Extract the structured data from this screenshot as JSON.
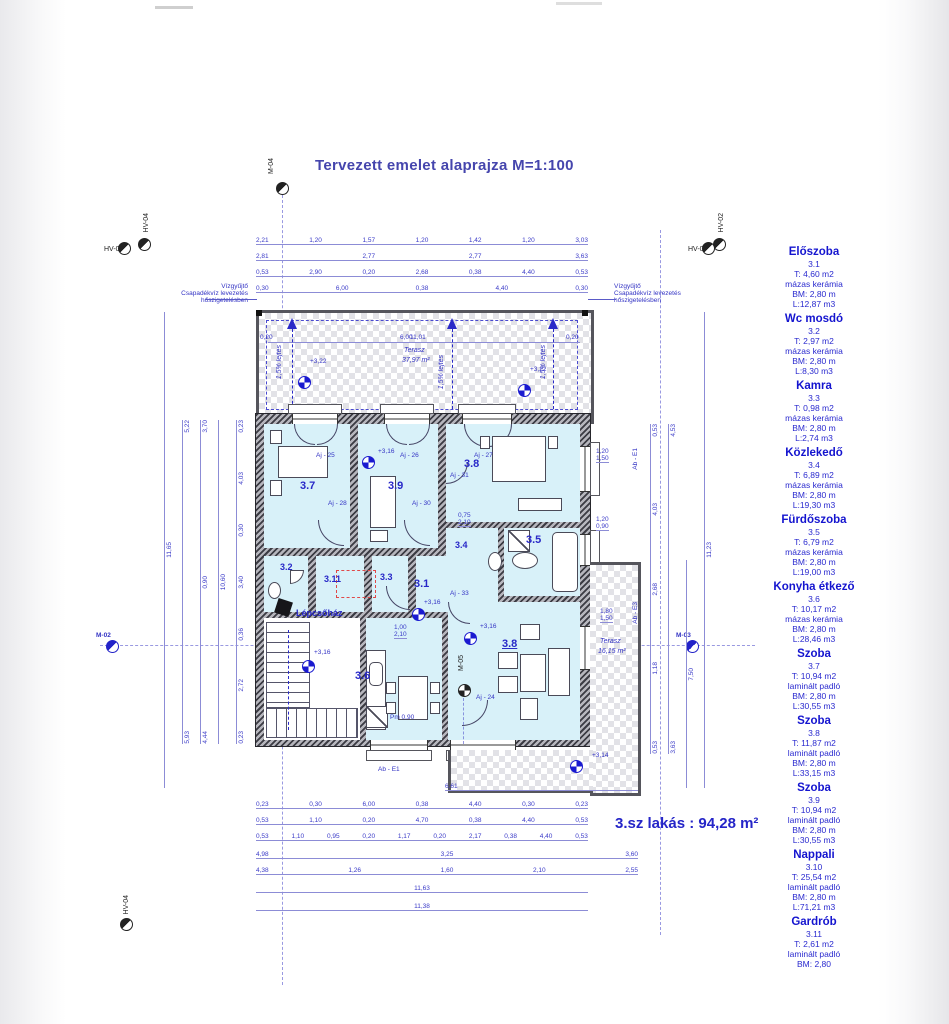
{
  "title": "Tervezett  emelet alaprajza M=1:100",
  "apartment_total": "3.sz lakás : 94,28 m²",
  "notes": {
    "line1": "Vízgyűjtő",
    "line2": "Csapadékvíz levezetés",
    "line3": "hőszigetelésben"
  },
  "markers": {
    "m04": "M-04",
    "m05": "M-05",
    "m02": "M-02",
    "m03": "M-03",
    "hv02": "HV-02",
    "hv03": "HV-03",
    "hv04": "HV-04"
  },
  "terrace_top": {
    "name": "Terasz",
    "area": "37,97 m²",
    "slope": "1,5% lejtés",
    "level": "+3,22",
    "width": "11,01",
    "edge": "0,20"
  },
  "terrace_right": {
    "name": "Terasz",
    "area": "16,15 m²",
    "level": "+3,14"
  },
  "levels": {
    "floor": "+3,16"
  },
  "rooms": {
    "r31": "3.1",
    "r32": "3.2",
    "r33": "3.3",
    "r34": "3.4",
    "r35": "3.5",
    "r36": "3.6",
    "r37": "3.7",
    "r38": "3.8",
    "r39": "3.9",
    "r311": "3.11",
    "living": "3.8",
    "stairs": "Lépcsőház"
  },
  "doors": {
    "aj24": "Aj - 24",
    "aj25": "Aj - 25",
    "aj26": "Aj - 26",
    "aj27": "Aj - 27",
    "aj28": "Aj - 28",
    "aj30": "Aj - 30",
    "aj31": "Aj - 31",
    "aj33": "Aj - 33"
  },
  "windows": {
    "abe1": "Ab - E1",
    "abe3": "Ab - E3"
  },
  "misc": {
    "pm": "Pm 0,90"
  },
  "dims": {
    "top": [
      [
        "2,21",
        "1,20",
        "1,57",
        "1,20",
        "1,42",
        "1,20",
        "3,03"
      ],
      [
        "2,81",
        "2,77",
        "2,77",
        "3,63"
      ],
      [
        "0,53",
        "2,90",
        "0,20",
        "2,68",
        "0,38",
        "4,40",
        "0,53"
      ],
      [
        "0,30",
        "6,00",
        "0,38",
        "4,40",
        "0,30"
      ]
    ],
    "bottom": [
      [
        "0,23",
        "0,30",
        "6,00",
        "0,38",
        "4,40",
        "0,30",
        "0,23"
      ],
      [
        "0,53",
        "1,10",
        "0,20",
        "4,70",
        "0,38",
        "4,40",
        "0,53"
      ],
      [
        "0,53",
        "1,10",
        "0,95",
        "0,20",
        "1,17",
        "0,20",
        "2,17",
        "0,38",
        "4,40",
        "0,53"
      ],
      [
        "4,98",
        "3,25",
        "3,60"
      ],
      [
        "4,38",
        "1,26",
        "1,60",
        "2,10",
        "2,55"
      ],
      [
        "11,63"
      ],
      [
        "11,38"
      ]
    ],
    "right_extra": [
      "6,61"
    ],
    "left_cols": [
      [
        "11,65"
      ],
      [
        "5,22",
        "5,93"
      ],
      [
        "3,70",
        "0,90",
        "4,44"
      ],
      [
        "10,60"
      ],
      [
        "0,23",
        "4,03",
        "0,30",
        "3,40",
        "0,36",
        "2,72",
        "0,23"
      ]
    ],
    "right_cols": [
      [
        "0,53",
        "4,03",
        "2,68",
        "1,18",
        "0,53"
      ],
      [
        "4,53",
        "3,63"
      ],
      [
        "7,50"
      ],
      [
        "11,23"
      ]
    ],
    "pairs": [
      {
        "a": "1,20",
        "b": "1,50"
      },
      {
        "a": "1,20",
        "b": "0,90"
      },
      {
        "a": "1,80",
        "b": "1,50"
      }
    ],
    "door_pairs": [
      {
        "a": "0,75",
        "b": "2,10"
      },
      {
        "a": "1,00",
        "b": "2,10"
      }
    ]
  },
  "legend": {
    "rooms": [
      {
        "name": "Előszoba",
        "number": "3.1",
        "area": "T: 4,60 m2",
        "floor": "mázas kerámia",
        "height": "BM: 2,80 m",
        "volume": "L:12,87 m3"
      },
      {
        "name": "Wc mosdó",
        "number": "3.2",
        "area": "T: 2,97 m2",
        "floor": "mázas kerámia",
        "height": "BM: 2,80 m",
        "volume": "L:8,30 m3"
      },
      {
        "name": "Kamra",
        "number": "3.3",
        "area": "T: 0,98 m2",
        "floor": "mázas kerámia",
        "height": "BM: 2,80 m",
        "volume": "L:2,74 m3"
      },
      {
        "name": "Közlekedő",
        "number": "3.4",
        "area": "T: 6,89 m2",
        "floor": "mázas kerámia",
        "height": "BM: 2,80 m",
        "volume": "L:19,30 m3"
      },
      {
        "name": "Fürdőszoba",
        "number": "3.5",
        "area": "T: 6,79 m2",
        "floor": "mázas kerámia",
        "height": "BM: 2,80 m",
        "volume": "L:19,00 m3"
      },
      {
        "name": "Konyha étkező",
        "number": "3.6",
        "area": "T: 10,17 m2",
        "floor": "mázas kerámia",
        "height": "BM: 2,80 m",
        "volume": "L:28,46 m3"
      },
      {
        "name": "Szoba",
        "number": "3.7",
        "area": "T: 10,94 m2",
        "floor": "laminált padló",
        "height": "BM: 2,80 m",
        "volume": "L:30,55 m3"
      },
      {
        "name": "Szoba",
        "number": "3.8",
        "area": "T: 11,87 m2",
        "floor": "laminált padló",
        "height": "BM: 2,80 m",
        "volume": "L:33,15 m3"
      },
      {
        "name": "Szoba",
        "number": "3.9",
        "area": "T: 10,94 m2",
        "floor": "laminált padló",
        "height": "BM: 2,80 m",
        "volume": "L:30,55 m3"
      },
      {
        "name": "Nappali",
        "number": "3.10",
        "area": "T: 25,54 m2",
        "floor": "laminált padló",
        "height": "BM: 2,80 m",
        "volume": "L:71,21 m3"
      },
      {
        "name": "Gardrób",
        "number": "3.11",
        "area": "T: 2,61 m2",
        "floor": "laminált padló",
        "height": "BM: 2,80",
        "volume": ""
      }
    ]
  }
}
